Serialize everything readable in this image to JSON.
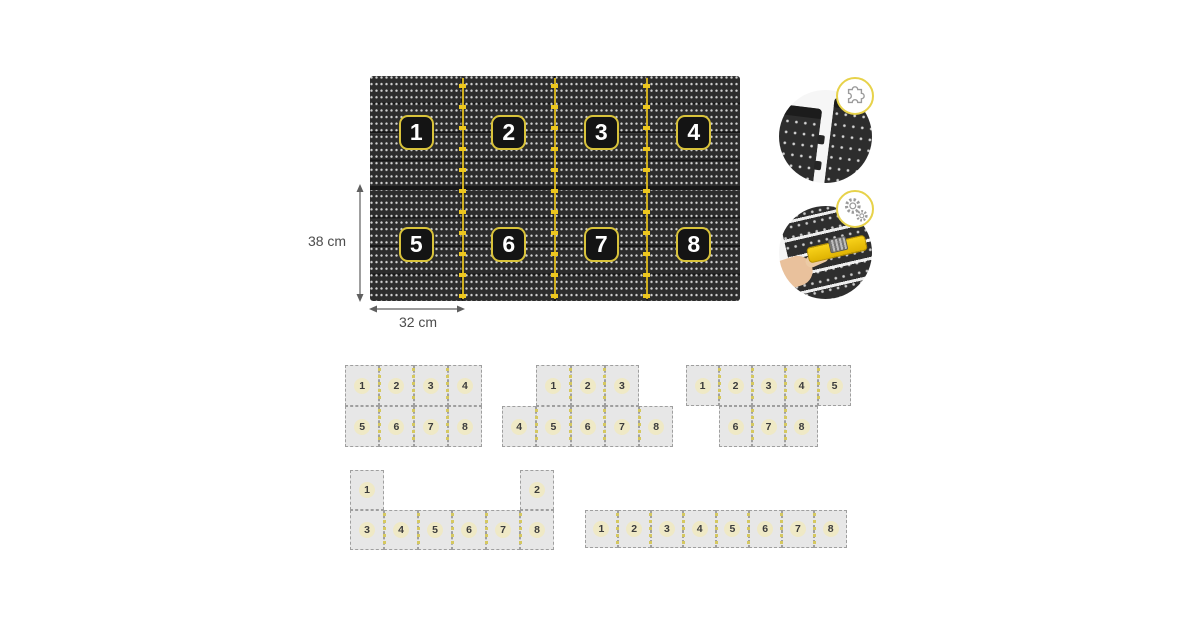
{
  "page": {
    "background": "#ffffff"
  },
  "main_board": {
    "cols": 4,
    "rows": 2,
    "panels": [
      "1",
      "2",
      "3",
      "4",
      "5",
      "6",
      "7",
      "8"
    ],
    "height_dimension": "38 cm",
    "width_dimension": "32 cm"
  },
  "insets": {
    "connection_detail": {
      "description": "two pegboard panels joining edge to edge",
      "badge_icon": "puzzle-icon"
    },
    "assembly_detail": {
      "description": "hand fastening yellow connector tool onto pegboard",
      "badge_icon": "gears-icon"
    }
  },
  "colors": {
    "accent_yellow": "#EDC71F",
    "board_dark": "#2C2C2C",
    "badge_background": "#141414",
    "badge_border": "#D9C33B",
    "badge_text": "#FFFFFF",
    "tile_gray": "#E7E7E7",
    "tile_border": "#9F9F9F",
    "tile_dash_yellow": "#D5C860",
    "tile_number_halo": "#EFE9C6",
    "dimension_text": "#4C4C4C",
    "tool_yellow": "#F8D21A",
    "hand_skin": "#E9C19C"
  },
  "layouts": [
    {
      "id": "grid-4x2",
      "x": 345,
      "y": 365,
      "tile_w": 34.25,
      "tile_h": 41,
      "tiles": [
        {
          "n": "1",
          "r": 0,
          "c": 0
        },
        {
          "n": "2",
          "r": 0,
          "c": 1
        },
        {
          "n": "3",
          "r": 0,
          "c": 2
        },
        {
          "n": "4",
          "r": 0,
          "c": 3
        },
        {
          "n": "5",
          "r": 1,
          "c": 0
        },
        {
          "n": "6",
          "r": 1,
          "c": 1
        },
        {
          "n": "7",
          "r": 1,
          "c": 2
        },
        {
          "n": "8",
          "r": 1,
          "c": 3
        }
      ]
    },
    {
      "id": "pyramid-3-over-5",
      "x": 502,
      "y": 365,
      "tile_w": 34.25,
      "tile_h": 41,
      "tiles": [
        {
          "n": "1",
          "r": 0,
          "c": 1
        },
        {
          "n": "2",
          "r": 0,
          "c": 2
        },
        {
          "n": "3",
          "r": 0,
          "c": 3
        },
        {
          "n": "4",
          "r": 1,
          "c": 0
        },
        {
          "n": "5",
          "r": 1,
          "c": 1
        },
        {
          "n": "6",
          "r": 1,
          "c": 2
        },
        {
          "n": "7",
          "r": 1,
          "c": 3
        },
        {
          "n": "8",
          "r": 1,
          "c": 4
        }
      ]
    },
    {
      "id": "5-over-3",
      "x": 686,
      "y": 365,
      "tile_w": 33,
      "tile_h": 41,
      "tiles": [
        {
          "n": "1",
          "r": 0,
          "c": 0
        },
        {
          "n": "2",
          "r": 0,
          "c": 1
        },
        {
          "n": "3",
          "r": 0,
          "c": 2
        },
        {
          "n": "4",
          "r": 0,
          "c": 3
        },
        {
          "n": "5",
          "r": 0,
          "c": 4
        },
        {
          "n": "6",
          "r": 1,
          "c": 1
        },
        {
          "n": "7",
          "r": 1,
          "c": 2
        },
        {
          "n": "8",
          "r": 1,
          "c": 3
        }
      ]
    },
    {
      "id": "u-shape",
      "x": 350,
      "y": 470,
      "tile_w": 34,
      "tile_h": 40,
      "tiles": [
        {
          "n": "1",
          "r": 0,
          "c": 0
        },
        {
          "n": "2",
          "r": 0,
          "c": 5
        },
        {
          "n": "3",
          "r": 1,
          "c": 0
        },
        {
          "n": "4",
          "r": 1,
          "c": 1
        },
        {
          "n": "5",
          "r": 1,
          "c": 2
        },
        {
          "n": "6",
          "r": 1,
          "c": 3
        },
        {
          "n": "7",
          "r": 1,
          "c": 4
        },
        {
          "n": "8",
          "r": 1,
          "c": 5
        }
      ]
    },
    {
      "id": "single-row-8",
      "x": 585,
      "y": 510,
      "tile_w": 32.75,
      "tile_h": 38,
      "tiles": [
        {
          "n": "1",
          "r": 0,
          "c": 0
        },
        {
          "n": "2",
          "r": 0,
          "c": 1
        },
        {
          "n": "3",
          "r": 0,
          "c": 2
        },
        {
          "n": "4",
          "r": 0,
          "c": 3
        },
        {
          "n": "5",
          "r": 0,
          "c": 4
        },
        {
          "n": "6",
          "r": 0,
          "c": 5
        },
        {
          "n": "7",
          "r": 0,
          "c": 6
        },
        {
          "n": "8",
          "r": 0,
          "c": 7
        }
      ]
    }
  ]
}
